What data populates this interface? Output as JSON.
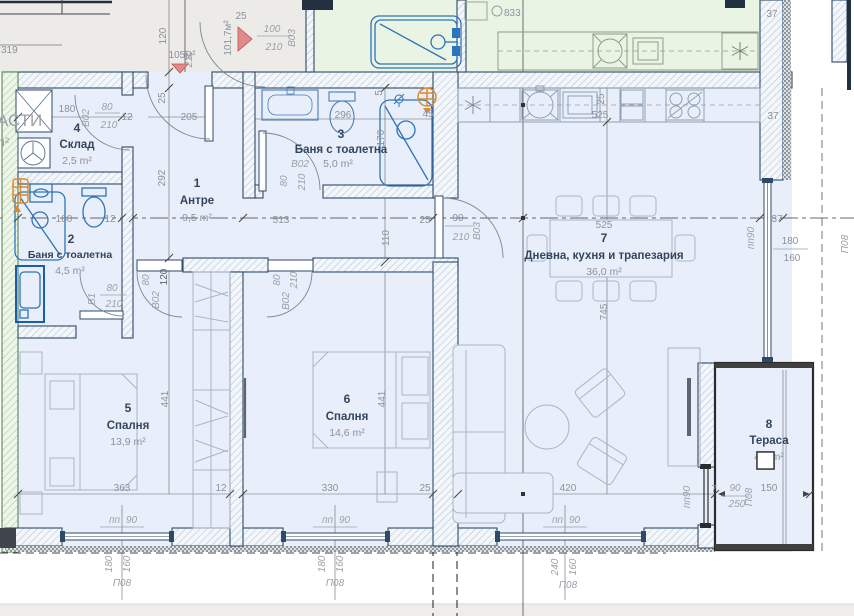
{
  "colors": {
    "floor": "#e9effa",
    "neighbor_floor": "#e9f4e4",
    "common_floor": "#ecebe7",
    "wall_line": "#2e4a68",
    "fixture_blue": "#2e74b8",
    "door_marker_red": "#e08a8a",
    "boiler_orange": "#d98a2e",
    "dim_text": "#8b929c",
    "room_text": "#32455e"
  },
  "common_area": {
    "d319": "319",
    "partial_label": "АСТИ",
    "unit": "m²",
    "d120": "120",
    "area_small": "105м²",
    "d25_top": "25",
    "area_rot": "101,7м²",
    "door_w": "100",
    "door_h": "210",
    "door_code": "B03",
    "d210_rot": "210",
    "d25_rot": "25",
    "d205": "205",
    "d292": "292"
  },
  "neighbor_flat": {
    "d833": "833",
    "d37_top": "37",
    "d37_mid": "37"
  },
  "rooms": {
    "hall": {
      "num": "1",
      "name": "Антре",
      "area": "9,5 m²",
      "d513": "513",
      "d110": "110",
      "d25": "25",
      "d120": "120"
    },
    "bath2": {
      "num": "2",
      "name": "Баня с тоалетна",
      "area": "4,5 m²",
      "d180": "180",
      "d12": "12",
      "door_w": "80",
      "door_h": "210",
      "door_code": "B1"
    },
    "bath3": {
      "num": "3",
      "name": "Баня с тоалетна",
      "area": "5,0 m²",
      "d296": "296",
      "d5": "5",
      "d45": "45",
      "d170": "170",
      "door_w": "80",
      "door_h": "210",
      "door_code": "B02"
    },
    "storage": {
      "num": "4",
      "name": "Склад",
      "area": "2,5 m²",
      "d180": "180",
      "d12": "12",
      "door_w": "80",
      "door_h": "210",
      "door_code": "B02"
    },
    "bed5": {
      "num": "5",
      "name": "Спалня",
      "area": "13,9 m²",
      "d363": "363",
      "d441": "441",
      "d12": "12",
      "door_w": "80",
      "door_code": "B02",
      "win_pp": "пп",
      "win_n": "90",
      "win_w": "180",
      "win_h": "160",
      "win_code": "П08"
    },
    "bed6": {
      "num": "6",
      "name": "Спалня",
      "area": "14,6 m²",
      "d330": "330",
      "d441": "441",
      "d25": "25",
      "door_w": "80",
      "door_h": "210",
      "door_code": "B02",
      "win_pp": "пп",
      "win_n": "90",
      "win_w": "180",
      "win_h": "160",
      "win_code": "П08"
    },
    "living": {
      "num": "7",
      "name": "Дневна, кухня и трапезария",
      "area": "36,0 m²",
      "d525": "525",
      "d745": "745",
      "d420": "420",
      "d37": "37",
      "k25": "25",
      "k525": "525",
      "door_w": "90",
      "door_h": "210",
      "door_code": "B03",
      "winb_pp": "пп",
      "winb_n": "90",
      "winb_w": "240",
      "winb_h": "160",
      "winb_code": "П08",
      "winr_pp": "пп90",
      "winr_w": "180",
      "winr_h": "160",
      "winr_code": "П08"
    },
    "terrace": {
      "num": "8",
      "name": "Тераса",
      "area": "4,9 m²",
      "d150": "150",
      "d7": "7",
      "door_w": "90",
      "door_h": "250",
      "door_code": "П08",
      "door_pp": "пп90"
    }
  }
}
